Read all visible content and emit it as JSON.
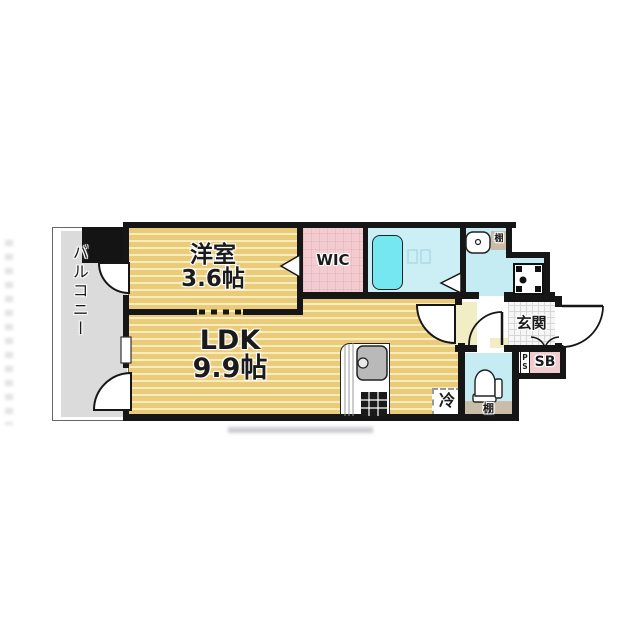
{
  "plan_type": "1LDK apartment floor plan",
  "rooms": {
    "balcony": {
      "label": "バルコニー"
    },
    "bedroom": {
      "name": "洋室",
      "size": "3.6帖"
    },
    "ldk": {
      "name": "LDK",
      "size": "9.9帖"
    },
    "wic": {
      "label": "WIC"
    },
    "entrance": {
      "label": "玄関"
    },
    "shoe_box": {
      "label": "SB"
    },
    "pipe_space": {
      "label": "PS"
    },
    "refrigerator_space": {
      "label": "冷"
    },
    "washroom_shelf": {
      "label": "棚"
    },
    "toilet_shelf": {
      "label": "棚"
    }
  },
  "colors": {
    "wall": "#161616",
    "room_yellow": "#EACB78",
    "room_yellow_stripe": "#F7ECC0",
    "closet_pink": "#F4CBD0",
    "wet_area_cyan": "#C5ECF3",
    "bathtub_cyan": "#74E7F0",
    "balcony_gray": "#DBDBDB",
    "hall_cream": "#F1EDC5",
    "shelf_beige": "#C9BCA8"
  }
}
